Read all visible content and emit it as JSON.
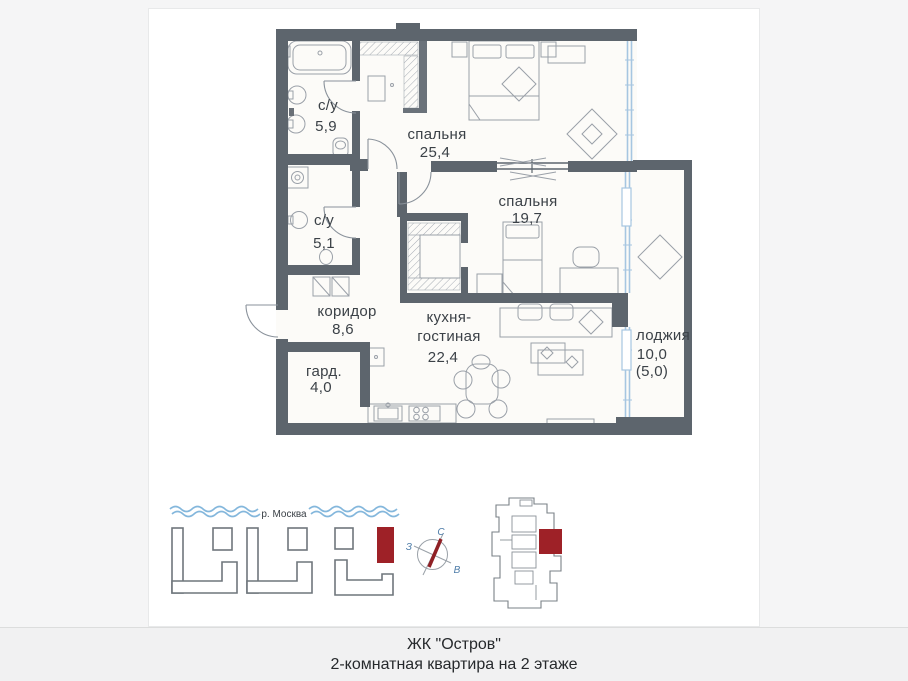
{
  "colors": {
    "wall": "#5d656d",
    "glazing": "#a6c6e1",
    "accent_red": "#9e2127",
    "furniture_stroke": "#9aa0a8",
    "label_text": "#3b4147",
    "compass_blue": "#4d7ca8",
    "wave_blue": "#84b7dc",
    "page_background": "#f5f5f6",
    "caption_background": "#f1f1f2"
  },
  "plan": {
    "rooms": [
      {
        "name": "с/у",
        "area": "5,9"
      },
      {
        "name": "спальня",
        "area": "25,4"
      },
      {
        "name": "спальня",
        "area": "19,7"
      },
      {
        "name": "с/у",
        "area": "5,1"
      },
      {
        "name": "коридор",
        "area": "8,6"
      },
      {
        "name": "кухня-",
        "name2": "гостиная",
        "area": "22,4"
      },
      {
        "name": "гард.",
        "area": "4,0"
      },
      {
        "name": "лоджия",
        "area": "10,0",
        "area2": "(5,0)"
      }
    ]
  },
  "site_plan": {
    "river": "р. Москва"
  },
  "compass": {
    "n": "С",
    "w": "З",
    "e": "В"
  },
  "caption": {
    "line1": "ЖК \"Остров\"",
    "line2": "2-комнатная квартира на 2 этаже"
  }
}
